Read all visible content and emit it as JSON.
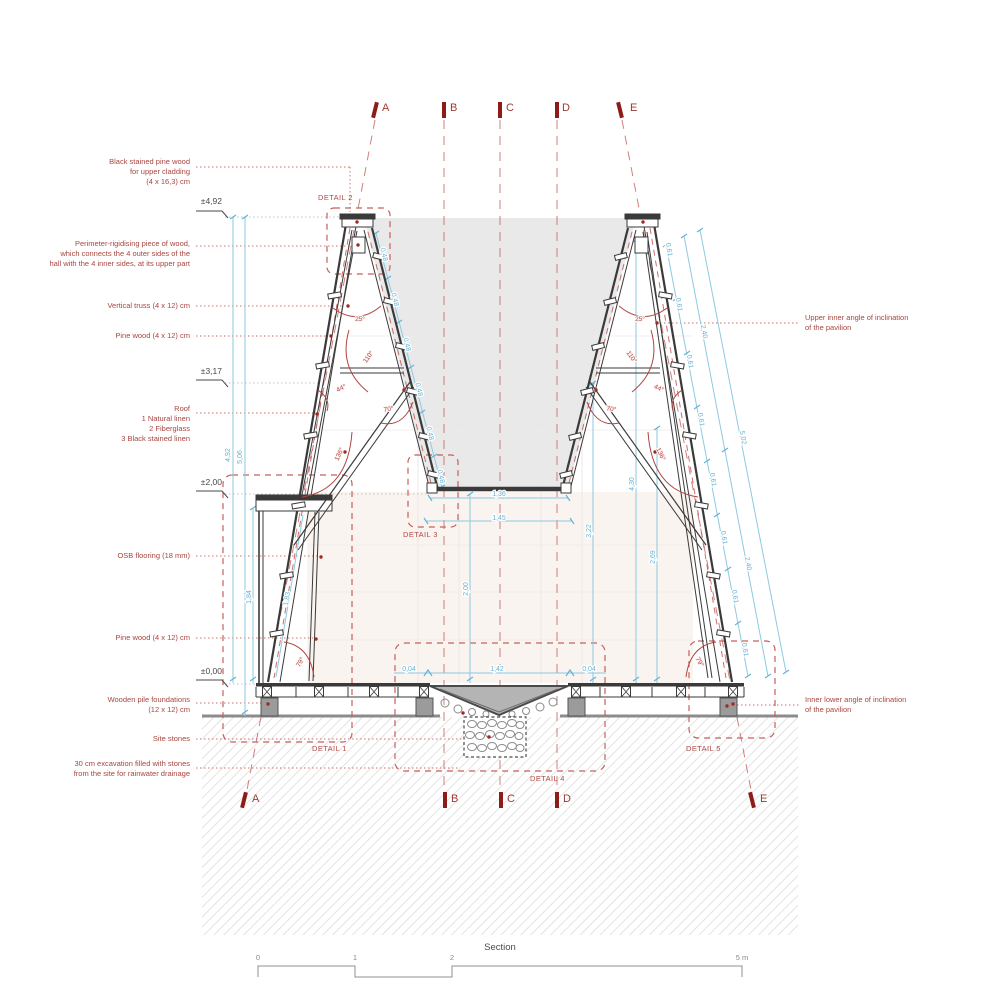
{
  "drawing_title": "Section",
  "colors": {
    "annotation_red": "#a8453f",
    "marker_red": "#8e1b18",
    "dimension_blue": "#64b3d4",
    "line_dark": "#3a3a3a"
  },
  "section_markers": {
    "a": "A",
    "b": "B",
    "c": "C",
    "d": "D",
    "e": "E"
  },
  "elevations": {
    "top": "±4,92",
    "mid": "±3,17",
    "floor2": "±2,00",
    "ground": "±0,00"
  },
  "left_annotations": [
    {
      "text": "Black stained pine wood\nfor upper cladding\n(4 x 16,3) cm"
    },
    {
      "text": "Perimeter-rigidising piece of wood,\nwhich connects the 4 outer sides of the\nhall with the 4 inner sides, at its upper part"
    },
    {
      "text": "Vertical truss (4 x 12) cm"
    },
    {
      "text": "Pine wood (4 x 12) cm"
    },
    {
      "text": "Roof\n1 Natural linen\n2 Fiberglass\n3 Black stained linen"
    },
    {
      "text": "OSB flooring (18 mm)"
    },
    {
      "text": "Pine wood (4 x 12) cm"
    },
    {
      "text": "Wooden pile foundations\n(12 x 12) cm"
    },
    {
      "text": "Site stones"
    },
    {
      "text": "30 cm excavation filled with stones\nfrom the site for rainwater drainage"
    }
  ],
  "right_annotations": [
    {
      "text": "Upper inner angle of inclination\nof the pavilion"
    },
    {
      "text": "Inner lower angle of inclination\nof the pavilion"
    }
  ],
  "details": {
    "d1": "DETAIL 1",
    "d2": "DETAIL 2",
    "d3": "DETAIL 3",
    "d4": "DETAIL 4",
    "d5": "DETAIL 5"
  },
  "dims": {
    "v492": "4,92",
    "v506": "5,06",
    "v184": "1,84",
    "v183": "1,83",
    "v200": "2,00",
    "v322": "3,22",
    "v430": "4,30",
    "v269": "2,69",
    "h136": "1,36",
    "h145": "1,45",
    "h142": "1,42",
    "h004": "0,04",
    "s048": "0,48",
    "s061": "0,61",
    "s240": "2,40",
    "s502": "5,02"
  },
  "angles": {
    "a25": "25°",
    "a110": "110°",
    "a44": "44°",
    "a70": "70°",
    "a136": "136°",
    "a79": "79°"
  },
  "scale_bar": {
    "t0": "0",
    "t1": "1",
    "t2": "2",
    "t5": "5 m"
  }
}
